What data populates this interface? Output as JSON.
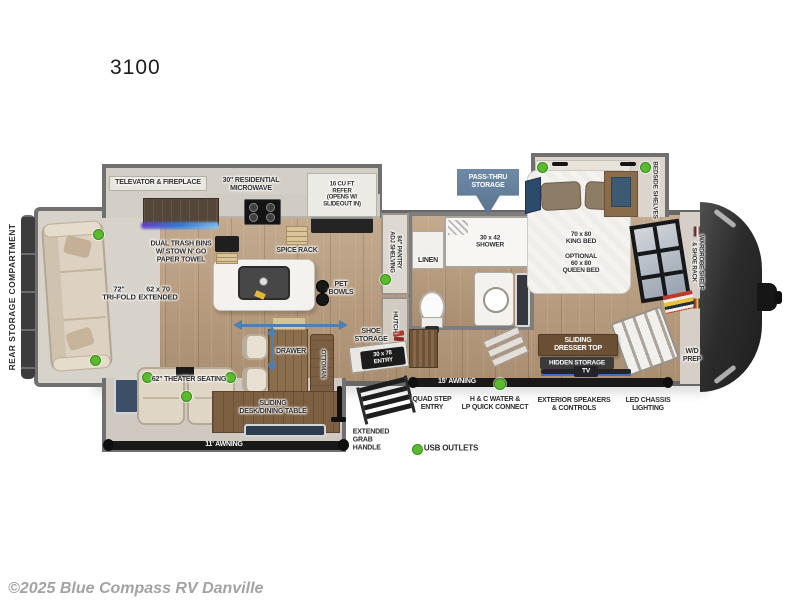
{
  "title": "3100",
  "watermark": "©2025 Blue Compass RV Danville",
  "legend": {
    "usb_outlets": "USB OUTLETS"
  },
  "colors": {
    "usb_dot_green": "#5bbb2e",
    "arrow_blue": "#4d7fb3",
    "passthru_blue": "#64809e"
  },
  "exterior": {
    "rear_storage": "REAR STORAGE COMPARTMENT",
    "awning_door_side": "11' AWNING",
    "awning_front": "15' AWNING",
    "pass_thru": "PASS-THRU\nSTORAGE",
    "entry_door": "30 x 78\nENTRY",
    "quad_step": "QUAD STEP\nENTRY",
    "water_connect": "H & C WATER &\nLP QUICK CONNECT",
    "speakers": "EXTERIOR SPEAKERS\n& CONTROLS",
    "chassis_lighting": "LED CHASSIS\nLIGHTING",
    "grab_handle": "EXTENDED\nGRAB\nHANDLE"
  },
  "living": {
    "televator": "TELEVATOR & FIREPLACE",
    "microwave": "30\" RESIDENTIAL\nMICROWAVE",
    "refer": "16 CU FT\nREFER\n(OPENS W/\nSLIDEOUT IN)",
    "trash": "DUAL TRASH BINS\nW/ STOW N' GO\nPAPER TOWEL",
    "spice_rack": "SPICE RACK",
    "pet_bowls": "PET\nBOWLS",
    "sofa_size": "72\"\nTRI-FOLD",
    "sofa_extended": "62 x 70\nEXTENDED",
    "theater": "62\" THEATER SEATING",
    "table": "SLIDING\nDESK/DINING TABLE",
    "drawer": "DRAWER",
    "ottoman": "OTTOMAN",
    "shoe_storage": "SHOE\nSTORAGE",
    "pantry": "84\" PANTRY\nADJ SHELVING",
    "hutch": "HUTCH"
  },
  "bath": {
    "shower": "30 x 42\nSHOWER",
    "linen": "LINEN"
  },
  "bedroom": {
    "bed": "70 x 80\nKING BED\n \nOPTIONAL\n60 x 80\nQUEEN BED",
    "bedside_shelves": "BEDSIDE SHELVES",
    "wardrobe": "WARDROBE SHELF\n& SHOE RACK",
    "dresser": "SLIDING\nDRESSER TOP",
    "hidden_storage": "HIDDEN STORAGE",
    "tv": "TV",
    "wd_prep": "W/D\nPREP"
  }
}
